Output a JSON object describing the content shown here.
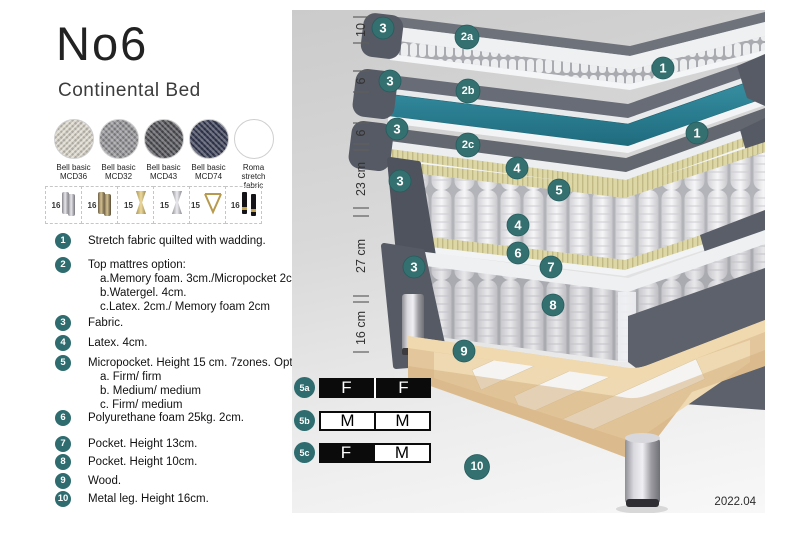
{
  "accent_color": "#2e6c6f",
  "watergel_color": "#2d7f92",
  "header": {
    "title": "No6",
    "subtitle": "Continental Bed"
  },
  "swatches": {
    "items": [
      {
        "line1": "Bell basic",
        "line2": "MCD36",
        "color": "#ddd8cd"
      },
      {
        "line1": "Bell basic",
        "line2": "MCD32",
        "color": "#97979b"
      },
      {
        "line1": "Bell basic",
        "line2": "MCD43",
        "color": "#54555a"
      },
      {
        "line1": "Bell basic",
        "line2": "MCD74",
        "color": "#383d55"
      },
      {
        "line1": "Roma",
        "line2": "stretch fabric",
        "color": "#ffffff"
      }
    ]
  },
  "legs": {
    "items": [
      {
        "height": "16",
        "type": "cylinder-silver"
      },
      {
        "height": "16",
        "type": "cylinder-bronze"
      },
      {
        "height": "15",
        "type": "twisted-gold"
      },
      {
        "height": "15",
        "type": "twisted-silver"
      },
      {
        "height": "15",
        "type": "hairpin-gold"
      },
      {
        "height": "16",
        "type": "tapered-black-gold"
      }
    ]
  },
  "list": {
    "items": [
      {
        "num": "1",
        "text": "Stretch fabric quilted with wadding."
      },
      {
        "num": "2",
        "text": "Top mattres option:",
        "subs": [
          "a.Memory foam. 3cm./Micropocket 2cm",
          "b.Watergel. 4cm.",
          "c.Latex. 2cm./ Memory foam 2cm"
        ]
      },
      {
        "num": "3",
        "text": "Fabric."
      },
      {
        "num": "4",
        "text": "Latex. 4cm."
      },
      {
        "num": "5",
        "text": "Micropocket. Height 15 cm. 7zones. Option:",
        "subs": [
          "a. Firm/ firm",
          "b. Medium/ medium",
          "c. Firm/ medium"
        ]
      },
      {
        "num": "6",
        "text": "Polyurethane foam 25kg. 2cm."
      },
      {
        "num": "7",
        "text": "Pocket. Height 13cm."
      },
      {
        "num": "8",
        "text": "Pocket. Height 10cm."
      },
      {
        "num": "9",
        "text": "Wood."
      },
      {
        "num": "10",
        "text": "Metal leg. Height 16cm."
      }
    ]
  },
  "diagram": {
    "measurements": [
      {
        "label": "10"
      },
      {
        "label": "6"
      },
      {
        "label": "6"
      },
      {
        "label": "23 cm"
      },
      {
        "label": "27 cm"
      },
      {
        "label": "16 cm"
      }
    ],
    "badges": [
      {
        "label": "3"
      },
      {
        "label": "2a"
      },
      {
        "label": "1"
      },
      {
        "label": "3"
      },
      {
        "label": "2b"
      },
      {
        "label": "1"
      },
      {
        "label": "3"
      },
      {
        "label": "2c"
      },
      {
        "label": "4"
      },
      {
        "label": "3"
      },
      {
        "label": "5"
      },
      {
        "label": "4"
      },
      {
        "label": "6"
      },
      {
        "label": "7"
      },
      {
        "label": "3"
      },
      {
        "label": "8"
      },
      {
        "label": "9"
      },
      {
        "label": "10"
      }
    ]
  },
  "firmness": {
    "rows": [
      {
        "badge": "5a",
        "cells": [
          {
            "label": "F",
            "variant": "dark"
          },
          {
            "label": "F",
            "variant": "dark"
          }
        ]
      },
      {
        "badge": "5b",
        "cells": [
          {
            "label": "M",
            "variant": "light"
          },
          {
            "label": "M",
            "variant": "light"
          }
        ]
      },
      {
        "badge": "5c",
        "cells": [
          {
            "label": "F",
            "variant": "dark"
          },
          {
            "label": "M",
            "variant": "light"
          }
        ]
      }
    ]
  },
  "version": "2022.04"
}
